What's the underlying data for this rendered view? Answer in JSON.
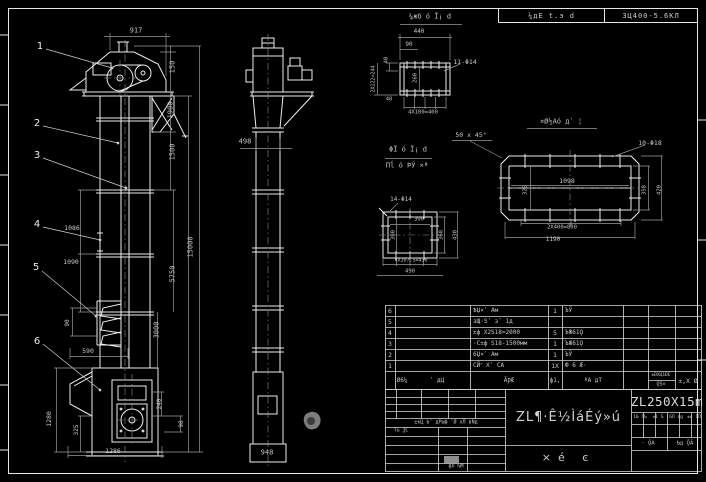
{
  "colors": {
    "background": "#000000",
    "main_line": "#ededed",
    "dim_line": "#9a9a9a",
    "dim_text": "#c6c6c6",
    "grid_line": "#d9d9d9",
    "highlight_cell": "#8f8f8f"
  },
  "sheet_header": {
    "left_cell": "¼дЕ t.э d",
    "right_cell": "3Ц400-5.6КЛ"
  },
  "title_block": {
    "model": "ZL250X15m",
    "title": "ZL¶·Ê½ÌáÉý»ú",
    "sheet_type": "×é ͼ",
    "labels": [
      {
        "n": "revision-header",
        "t": "±кЦ Ьʹ дΡшф ʹǾ хЛ вÑд",
        "x": 446,
        "y": 423,
        "s": 5
      },
      {
        "n": "designer-row-label",
        "t": "Ƭь ѮС",
        "x": 401,
        "y": 431,
        "s": 5
      },
      {
        "n": "approver-row-label",
        "t": "фЛ ƕМ",
        "x": 456,
        "y": 467,
        "s": 5
      },
      {
        "n": "stage-col-header",
        "t": "1Ƕ ΓЬ",
        "x": 640,
        "y": 418,
        "s": 4.5
      },
      {
        "n": "weight-col-header",
        "t": "±1 Ǧ",
        "x": 658,
        "y": 418,
        "s": 4.5
      },
      {
        "n": "scale-col-header",
        "t": "ǴЛ ɛg",
        "x": 676,
        "y": 418,
        "s": 4.5
      },
      {
        "n": "ratio-col-header",
        "t": "±ь 1Ǘ",
        "x": 694,
        "y": 418,
        "s": 4.5
      },
      {
        "n": "sheet-count-label",
        "t": "· ǬА",
        "x": 648,
        "y": 444,
        "s": 5.5
      },
      {
        "n": "sheet-number-label",
        "t": "Ƅд ǬĀ",
        "x": 685,
        "y": 444,
        "s": 5.5
      }
    ]
  },
  "annotations": {
    "front_view": [
      {
        "n": "balloon-1",
        "t": "1",
        "x": 40,
        "y": 47,
        "s": 10,
        "c": "balloon"
      },
      {
        "n": "balloon-2",
        "t": "2",
        "x": 37,
        "y": 124,
        "s": 10,
        "c": "balloon"
      },
      {
        "n": "balloon-3",
        "t": "3",
        "x": 37,
        "y": 156,
        "s": 10,
        "c": "balloon"
      },
      {
        "n": "balloon-4",
        "t": "4",
        "x": 37,
        "y": 225,
        "s": 10,
        "c": "balloon"
      },
      {
        "n": "balloon-5",
        "t": "5",
        "x": 36,
        "y": 268,
        "s": 10,
        "c": "balloon"
      },
      {
        "n": "balloon-6",
        "t": "6",
        "x": 37,
        "y": 342,
        "s": 10,
        "c": "balloon"
      },
      {
        "n": "dim-917",
        "t": "917",
        "x": 136,
        "y": 31
      },
      {
        "n": "dim-150",
        "t": "150",
        "x": 173,
        "y": 67,
        "r": -90
      },
      {
        "n": "dim-1900",
        "t": "1900",
        "x": 171,
        "y": 110,
        "r": -90
      },
      {
        "n": "dim-1500",
        "t": "1500",
        "x": 173,
        "y": 152,
        "r": -90
      },
      {
        "n": "dim-15000",
        "t": "15000",
        "x": 191,
        "y": 247,
        "r": -90
      },
      {
        "n": "dim-5750",
        "t": "5750",
        "x": 173,
        "y": 274,
        "r": -90
      },
      {
        "n": "dim-3000",
        "t": "3000",
        "x": 157,
        "y": 330,
        "r": -90
      },
      {
        "n": "dim-240",
        "t": "240",
        "x": 160,
        "y": 404,
        "r": -90,
        "s": 6
      },
      {
        "n": "dim-98",
        "t": "98",
        "x": 182,
        "y": 424,
        "r": -90,
        "s": 6
      },
      {
        "n": "dim-1086",
        "t": "1086",
        "x": 72,
        "y": 228,
        "s": 6.5
      },
      {
        "n": "dim-1090",
        "t": "1090",
        "x": 71,
        "y": 262,
        "s": 6.5
      },
      {
        "n": "dim-90",
        "t": "90",
        "x": 68,
        "y": 323,
        "r": -90,
        "s": 6
      },
      {
        "n": "dim-590",
        "t": "590",
        "x": 88,
        "y": 351,
        "s": 6.5
      },
      {
        "n": "dim-1280",
        "t": "1280",
        "x": 49,
        "y": 419,
        "r": -90,
        "s": 6.5
      },
      {
        "n": "dim-325",
        "t": "325",
        "x": 77,
        "y": 430,
        "r": -90,
        "s": 6
      },
      {
        "n": "dim-1286",
        "t": "1286",
        "x": 113,
        "y": 451,
        "s": 6.5
      }
    ],
    "side_view": [
      {
        "n": "dim-498",
        "t": "498",
        "x": 245,
        "y": 142
      },
      {
        "n": "dim-948",
        "t": "948",
        "x": 267,
        "y": 453
      }
    ],
    "detail_top": [
      {
        "n": "view-label-top-detail",
        "t": "¼жб ó Ī¡ d",
        "x": 430,
        "y": 17,
        "s": 7
      },
      {
        "n": "dim-440",
        "t": "440",
        "x": 419,
        "y": 32,
        "s": 6
      },
      {
        "n": "dim-90-offset",
        "t": "90",
        "x": 409,
        "y": 45,
        "s": 6
      },
      {
        "n": "dim-40",
        "t": "40",
        "x": 387,
        "y": 60,
        "r": -90,
        "s": 5.5
      },
      {
        "n": "dim-2x122",
        "t": "2X122=244",
        "x": 374,
        "y": 79,
        "r": -90,
        "s": 5
      },
      {
        "n": "dim-260",
        "t": "260",
        "x": 416,
        "y": 78,
        "r": -90,
        "s": 5.5
      },
      {
        "n": "dim-40-b",
        "t": "40",
        "x": 389,
        "y": 100,
        "s": 5.5
      },
      {
        "n": "dim-4x100",
        "t": "4X100=400",
        "x": 423,
        "y": 113,
        "s": 5.5
      },
      {
        "n": "hole-note-11-phi14",
        "t": "11-Φ14",
        "x": 465,
        "y": 62,
        "s": 6.5
      },
      {
        "n": "chamfer-note",
        "t": "50 x 45°",
        "x": 471,
        "y": 135,
        "s": 6.5
      }
    ],
    "view_titles": [
      {
        "n": "view-label-square-line1",
        "t": "ΦΪ ó Ī¡ d",
        "x": 408,
        "y": 150,
        "s": 7
      },
      {
        "n": "view-label-square-line2",
        "t": "Πĺ ó ÞЎ ×ª",
        "x": 407,
        "y": 166,
        "s": 7
      },
      {
        "n": "view-label-long",
        "t": "¤Ø½Аó дʹ ¦",
        "x": 561,
        "y": 122,
        "s": 7
      }
    ],
    "detail_square": [
      {
        "n": "hole-note-14-phi14",
        "t": "14-Φ14",
        "x": 401,
        "y": 200,
        "s": 6
      },
      {
        "n": "dim-300-h",
        "t": "300",
        "x": 419,
        "y": 220,
        "s": 5.5
      },
      {
        "n": "dim-300-v",
        "t": "300",
        "x": 394,
        "y": 235,
        "r": -90,
        "s": 5.5
      },
      {
        "n": "dim-368",
        "t": "368",
        "x": 442,
        "y": 235,
        "r": -90,
        "s": 5.5
      },
      {
        "n": "dim-430",
        "t": "430",
        "x": 456,
        "y": 235,
        "r": -90,
        "s": 5.5
      },
      {
        "n": "dim-4x107",
        "t": "4X107.5=430",
        "x": 411,
        "y": 261,
        "s": 5
      },
      {
        "n": "dim-490",
        "t": "490",
        "x": 410,
        "y": 272,
        "s": 5.5
      }
    ],
    "detail_long": [
      {
        "n": "hole-note-10-phi18",
        "t": "10-Φ18",
        "x": 650,
        "y": 143,
        "s": 6.5
      },
      {
        "n": "dim-1098",
        "t": "1098",
        "x": 567,
        "y": 181,
        "s": 6.5
      },
      {
        "n": "dim-325-left",
        "t": "325",
        "x": 526,
        "y": 190,
        "r": -90,
        "s": 5.5
      },
      {
        "n": "dim-358",
        "t": "358",
        "x": 645,
        "y": 190,
        "r": -90,
        "s": 5.5
      },
      {
        "n": "dim-420",
        "t": "420",
        "x": 660,
        "y": 190,
        "r": -90,
        "s": 5.5
      },
      {
        "n": "dim-2x400",
        "t": "2X400=800",
        "x": 562,
        "y": 228,
        "s": 5.5
      },
      {
        "n": "dim-1190",
        "t": "1190",
        "x": 553,
        "y": 240,
        "s": 6
      }
    ]
  },
  "parts_table": {
    "headers": [
      {
        "t": "Ø6¼",
        "x": 402
      },
      {
        "t": "ʹ дЦ",
        "x": 437
      },
      {
        "t": "ÃǷÆ",
        "x": 509
      },
      {
        "t": "ф1,",
        "x": 555
      },
      {
        "t": "ªА дТ",
        "x": 593
      },
      {
        "t": "±ƉХЦ1ƉЕ",
        "x": 661,
        "y": 376,
        "s": 4.5
      },
      {
        "t": "ǬЅ×",
        "x": 661,
        "y": 385,
        "s": 5
      },
      {
        "t": "±,Х Ø",
        "x": 688,
        "s": 6.5
      }
    ],
    "rows": [
      {
        "no": "6",
        "code": "",
        "name": "ѢЏ×ʹ Ам",
        "qty": "1",
        "material": "ЪЎ"
      },
      {
        "no": "5",
        "code": "",
        "name": "зЩ·Ѕʹ зʹ 1д",
        "qty": "",
        "material": ""
      },
      {
        "no": "4",
        "code": "",
        "name": "±ф Х2Ѕ18=2000",
        "qty": "5",
        "material": "ЪЖ61Ǫ"
      },
      {
        "no": "3",
        "code": "",
        "name": "·С±ф Ѕ18-1500мм",
        "qty": "1",
        "material": "ЪЖ61Ǫ"
      },
      {
        "no": "2",
        "code": "",
        "name": "6Џ×ʹ Ам",
        "qty": "1",
        "material": "ЪЎ"
      },
      {
        "no": "1",
        "code": "",
        "name": "СЙʺ Хʹ СА",
        "qty": "1Х",
        "material": "Ф 6 Æ·"
      }
    ]
  }
}
